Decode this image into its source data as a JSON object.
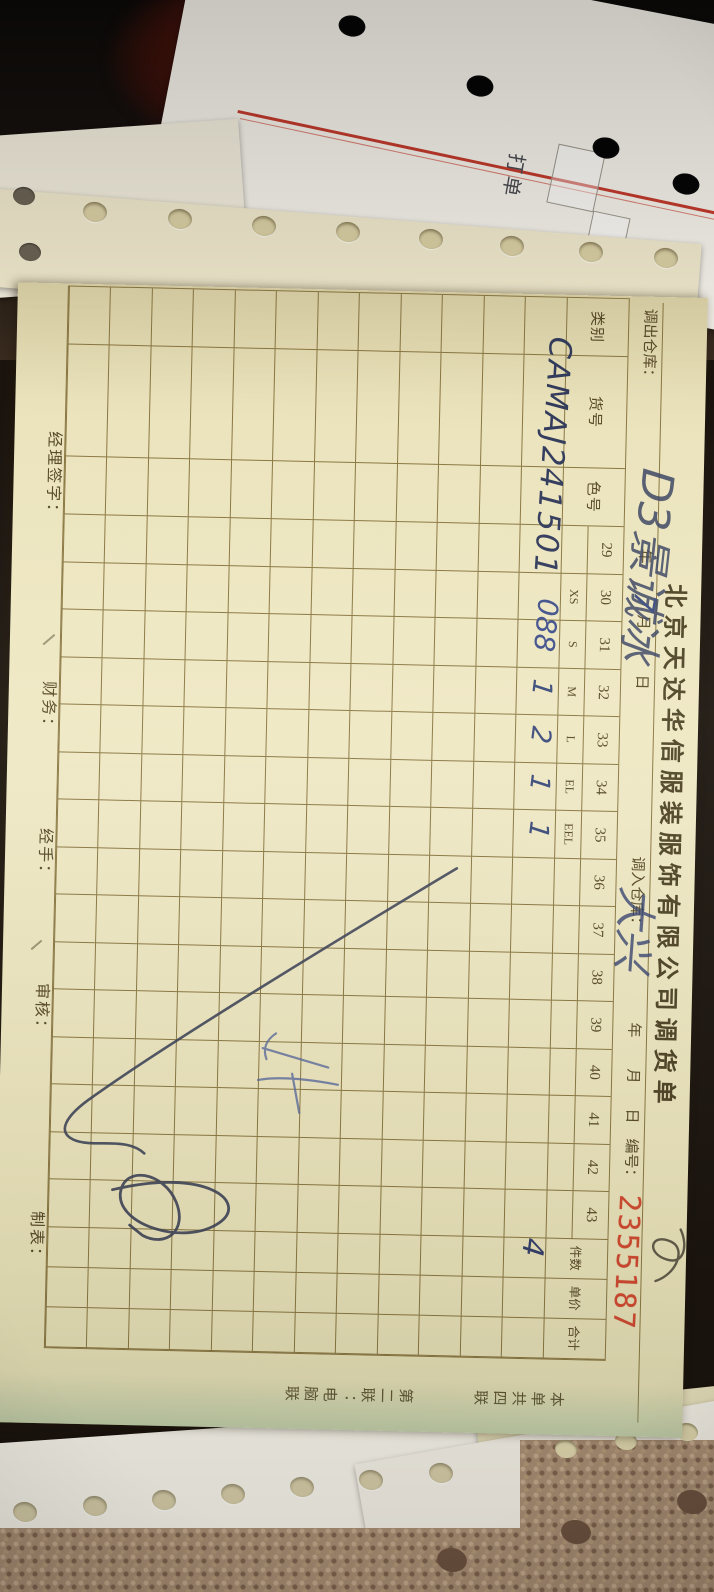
{
  "form": {
    "title": "北京天达华信服装服饰有限公司调货单",
    "outbound": {
      "label": "调出仓库：",
      "handwriting": "D3景诚冰",
      "year": "年",
      "month": "月",
      "day": "日",
      "month_handwritten": "7"
    },
    "inbound": {
      "label": "调入仓库：",
      "handwriting": "大兴",
      "year": "年",
      "month": "月",
      "day": "日"
    },
    "serial": {
      "label": "编号：",
      "number": "2355187"
    },
    "table": {
      "fixed_columns_left": [
        "类别",
        "货号",
        "色号"
      ],
      "size_columns": [
        "29",
        "30",
        "31",
        "32",
        "33",
        "34",
        "35",
        "36",
        "37",
        "38",
        "39",
        "40",
        "41",
        "42",
        "43"
      ],
      "size_letters": [
        "",
        "XS",
        "S",
        "M",
        "L",
        "EL",
        "EEL",
        "",
        "",
        "",
        "",
        "",
        "",
        "",
        ""
      ],
      "right_columns": [
        "件数",
        "单价",
        "合计"
      ],
      "body_rows": 12,
      "entry": {
        "item_no": "CAMAJ241501",
        "color_no": "088",
        "quantities": [
          {
            "size": "32",
            "qty": "1"
          },
          {
            "size": "33",
            "qty": "2"
          },
          {
            "size": "34",
            "qty": "1"
          },
          {
            "size": "35",
            "qty": "1"
          }
        ],
        "pieces_total": "4"
      }
    },
    "footer_labels": [
      "经理签字：",
      "财务：",
      "经手：",
      "审核：",
      "制表："
    ],
    "margin_note_line1": "本单共四联",
    "margin_note_line2": "第二联：电脑联"
  },
  "top_sheet": {
    "label": "打单"
  },
  "colors": {
    "paper": "#ece5bf",
    "grid_line": "#8a7742",
    "serial_red": "#cf4a30",
    "ink_blue": "#3c4663"
  }
}
